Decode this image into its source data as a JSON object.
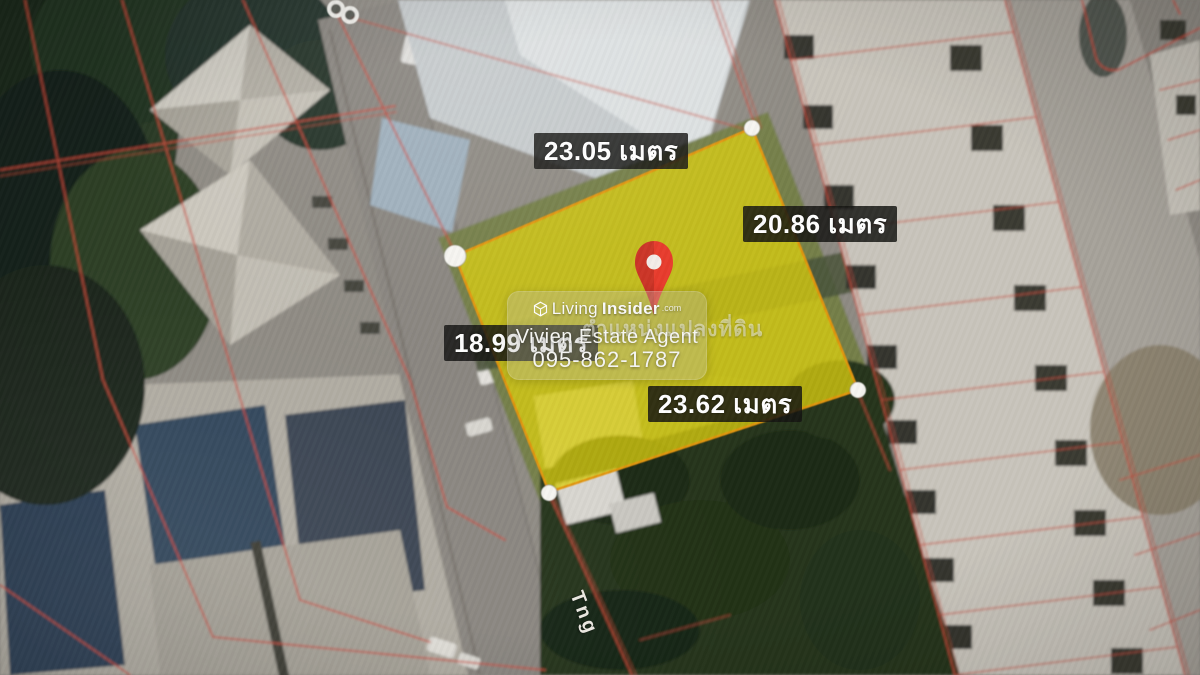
{
  "plot": {
    "measurements": {
      "top": "23.05 เมตร",
      "right": "20.86 เมตร",
      "left": "18.99 เมตร",
      "bottom": "23.62 เมตร"
    },
    "colors": {
      "highlight_fill": "#d8cd15",
      "highlight_stroke": "#e2950f",
      "parcel_line": "#c94b3c",
      "pin": "#e8392a",
      "label_bg": "#141412",
      "label_text": "#ffffff"
    }
  },
  "street_label": "Tng",
  "watermark": {
    "brand_light": "Living",
    "brand_bold": "Insider",
    "brand_tld": ".com",
    "caption_thai": "ตำแหน่งแปลงที่ดิน",
    "agent_name": "Vivien Estate Agent",
    "agent_phone": "095-862-1787"
  }
}
